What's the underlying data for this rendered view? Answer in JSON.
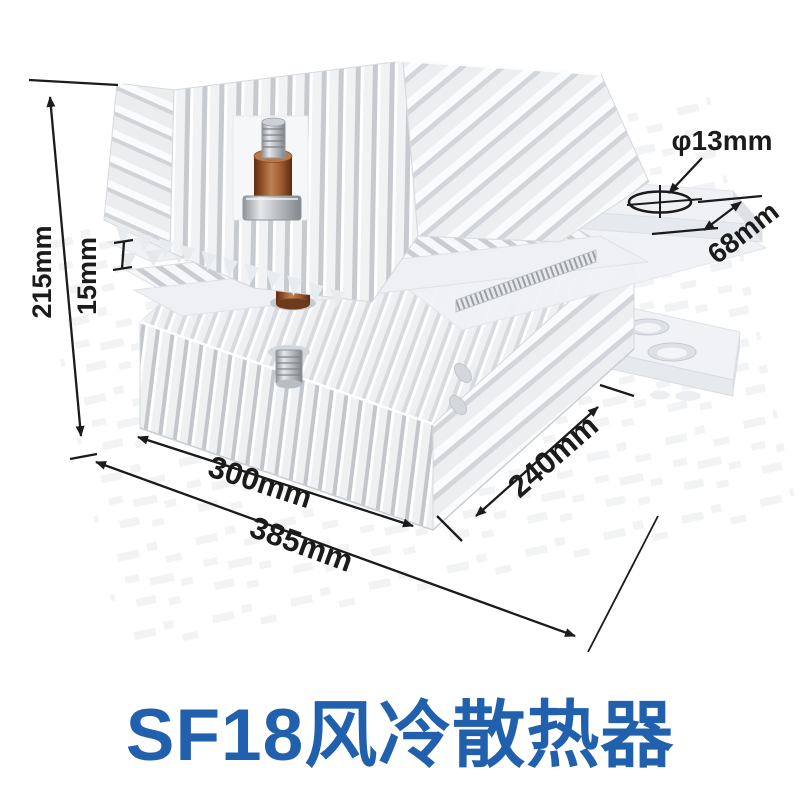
{
  "title": {
    "text": "SF18风冷散热器",
    "color": "#2160ac"
  },
  "dimensions": {
    "height": "215mm",
    "plate_gap": "15mm",
    "hole_diameter": "φ13mm",
    "terminal_width": "68mm",
    "fin_body_length": "300mm",
    "depth": "240mm",
    "overall_length": "385mm"
  },
  "colors": {
    "accent_blue": "#2160ac",
    "dimension_line": "#1b1b1b",
    "metal_light": "#f1f2f4",
    "metal_shadow": "#c9cdd2",
    "copper_insulator": "#9c5a30"
  }
}
